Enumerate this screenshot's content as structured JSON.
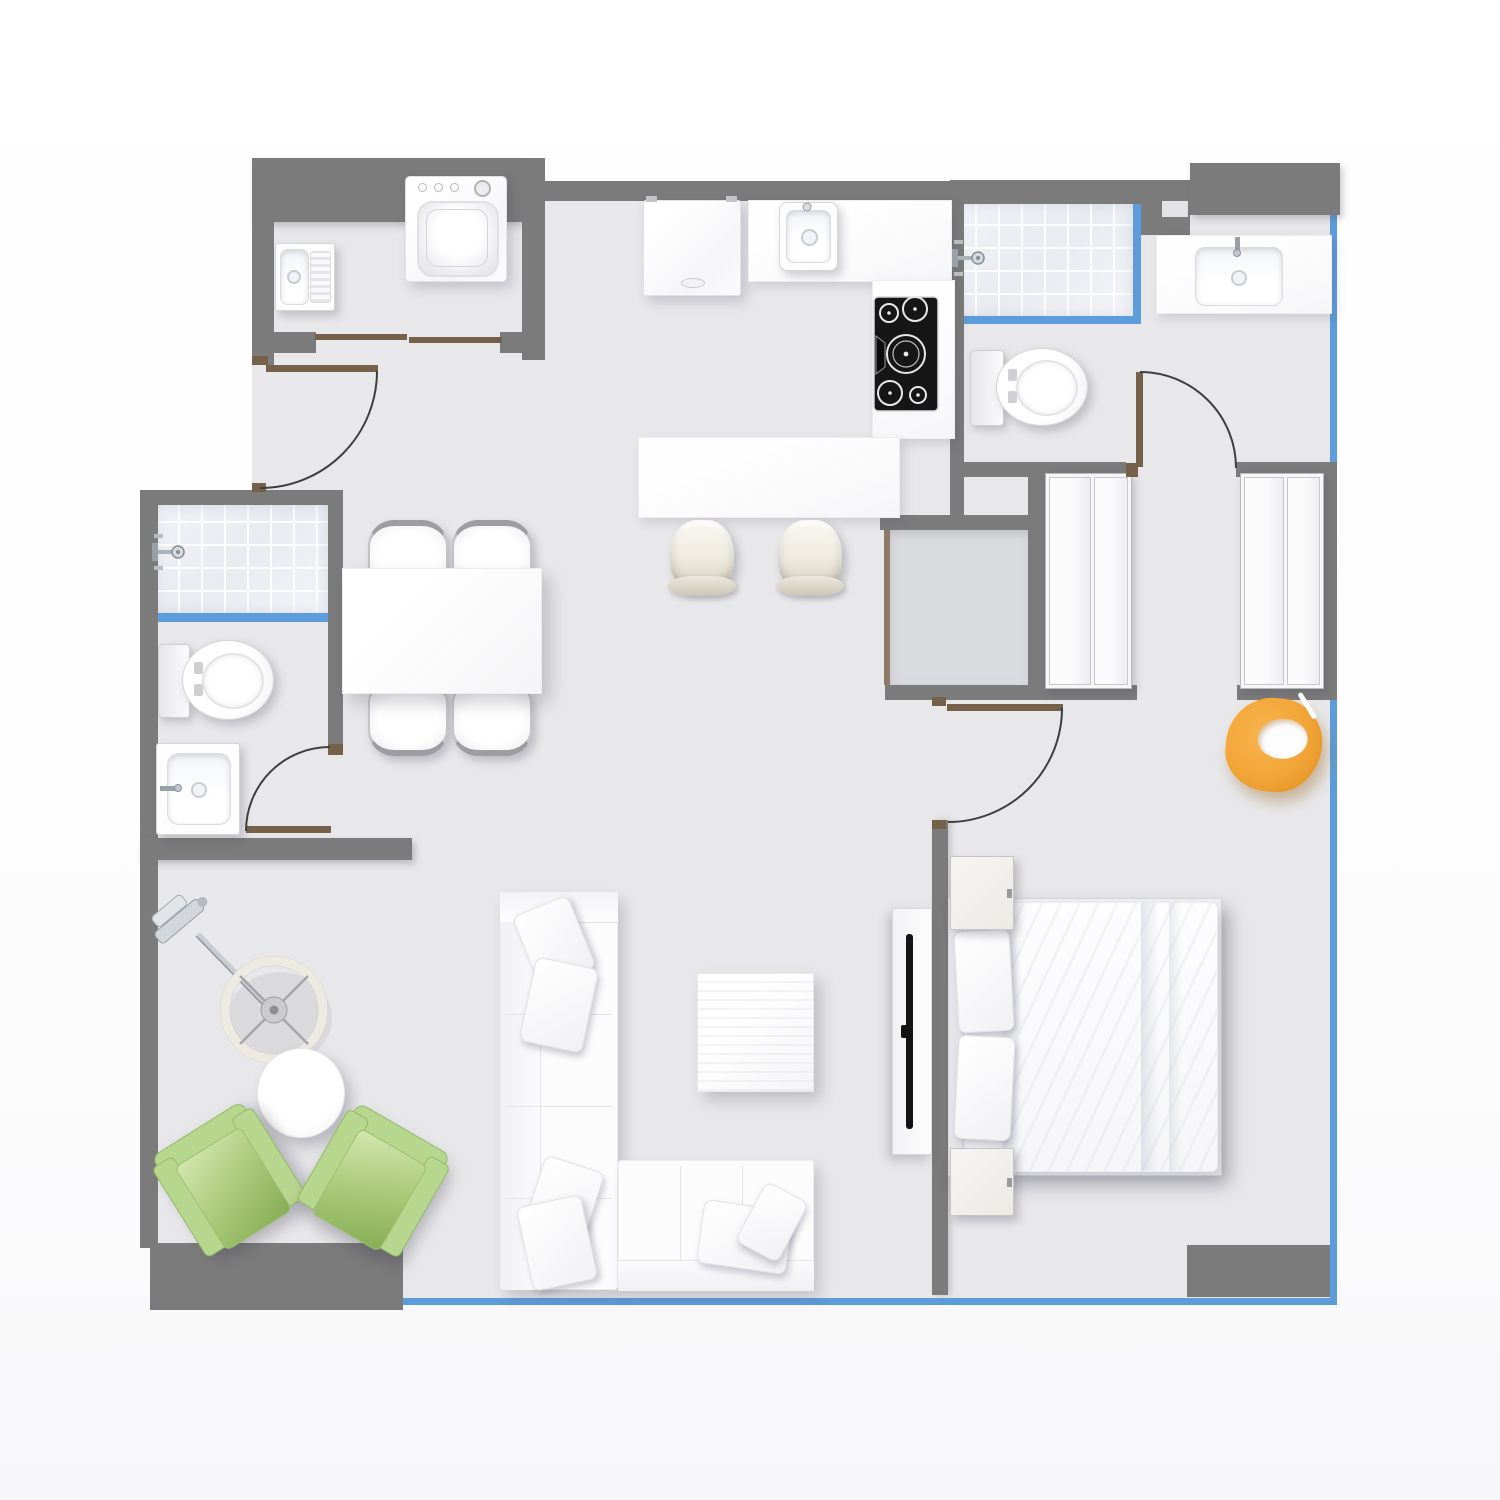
{
  "app": {
    "type": "architectural-floor-plan-top-view",
    "canvas_width": 1500,
    "canvas_height": 1500,
    "visible_text": ""
  },
  "palette": {
    "outside": "#ffffff",
    "floor": "#e8e8ea",
    "storage_floor": "#dadbdf",
    "wall": "#7b7b7b",
    "window_glass": "#5d9cdb",
    "door_wood": "#75604a",
    "door_arc": "#3f3f3f",
    "shower_tile": "#eef0f5",
    "furniture_white": "#fbfbfc",
    "cooktop_black": "#161616",
    "armchair_green": "#aecd7f",
    "chair_orange": "#f3a73f",
    "lamp_ring": "#edeae2",
    "chrome": "#b9bcc1"
  },
  "objects": {
    "washer": "washing machine",
    "laundry_sink": "utility sink",
    "sliding_door": "sliding door",
    "entry_door": "entry door",
    "fridge": "refrigerator",
    "kitchen_sink": "kitchen sink",
    "counter": "kitchen counter",
    "cooktop": "cooktop with five burners",
    "bar_stool": "bar stool",
    "dining_table": "dining table",
    "dining_chair": "dining chair",
    "shower": "tiled shower with glass screen",
    "toilet": "toilet",
    "washbasin": "washbasin",
    "vanity": "vanity sink",
    "interior_door": "interior door",
    "wardrobe": "wardrobe closet",
    "storage": "storage closet",
    "orange_chair": "orange lounge chair",
    "bed": "double bed",
    "bed_pillow": "bed pillow",
    "nightstand": "nightstand",
    "tv_console": "tv console",
    "sofa": "l-shaped sectional sofa",
    "sofa_pillow": "sofa pillow",
    "coffee_table": "coffee table",
    "side_table": "round side table",
    "arc_lamp": "arc floor lamp",
    "green_armchair": "green armchair",
    "window_wall": "glass window wall"
  },
  "rooms": {
    "laundry": {
      "fixtures": [
        "utility-sink",
        "washing-machine",
        "sliding-door"
      ]
    },
    "kitchen": {
      "fixtures": [
        "refrigerator",
        "kitchen-sink",
        "c-shaped-counter",
        "cooktop",
        "bar-stool",
        "bar-stool"
      ]
    },
    "dining": {
      "fixtures": [
        "dining-table",
        "dining-chair",
        "dining-chair",
        "dining-chair",
        "dining-chair"
      ]
    },
    "bathroom_left": {
      "fixtures": [
        "shower",
        "toilet",
        "washbasin",
        "swing-door"
      ]
    },
    "bathroom_right": {
      "fixtures": [
        "shower",
        "toilet",
        "vanity-sink",
        "swing-door"
      ]
    },
    "hallway": {
      "fixtures": [
        "entry-door",
        "storage-closet",
        "wardrobe",
        "wardrobe",
        "orange-lounge-chair"
      ]
    },
    "bedroom": {
      "fixtures": [
        "double-bed",
        "pillow",
        "pillow",
        "nightstand",
        "nightstand",
        "tv-console",
        "swing-door"
      ]
    },
    "living": {
      "fixtures": [
        "sectional-sofa",
        "coffee-table",
        "arc-floor-lamp",
        "round-side-table",
        "green-armchair",
        "green-armchair"
      ]
    },
    "glazing": [
      "right-glass-wall",
      "bottom-glass-wall",
      "shower-glass-left",
      "shower-glass-right"
    ]
  }
}
